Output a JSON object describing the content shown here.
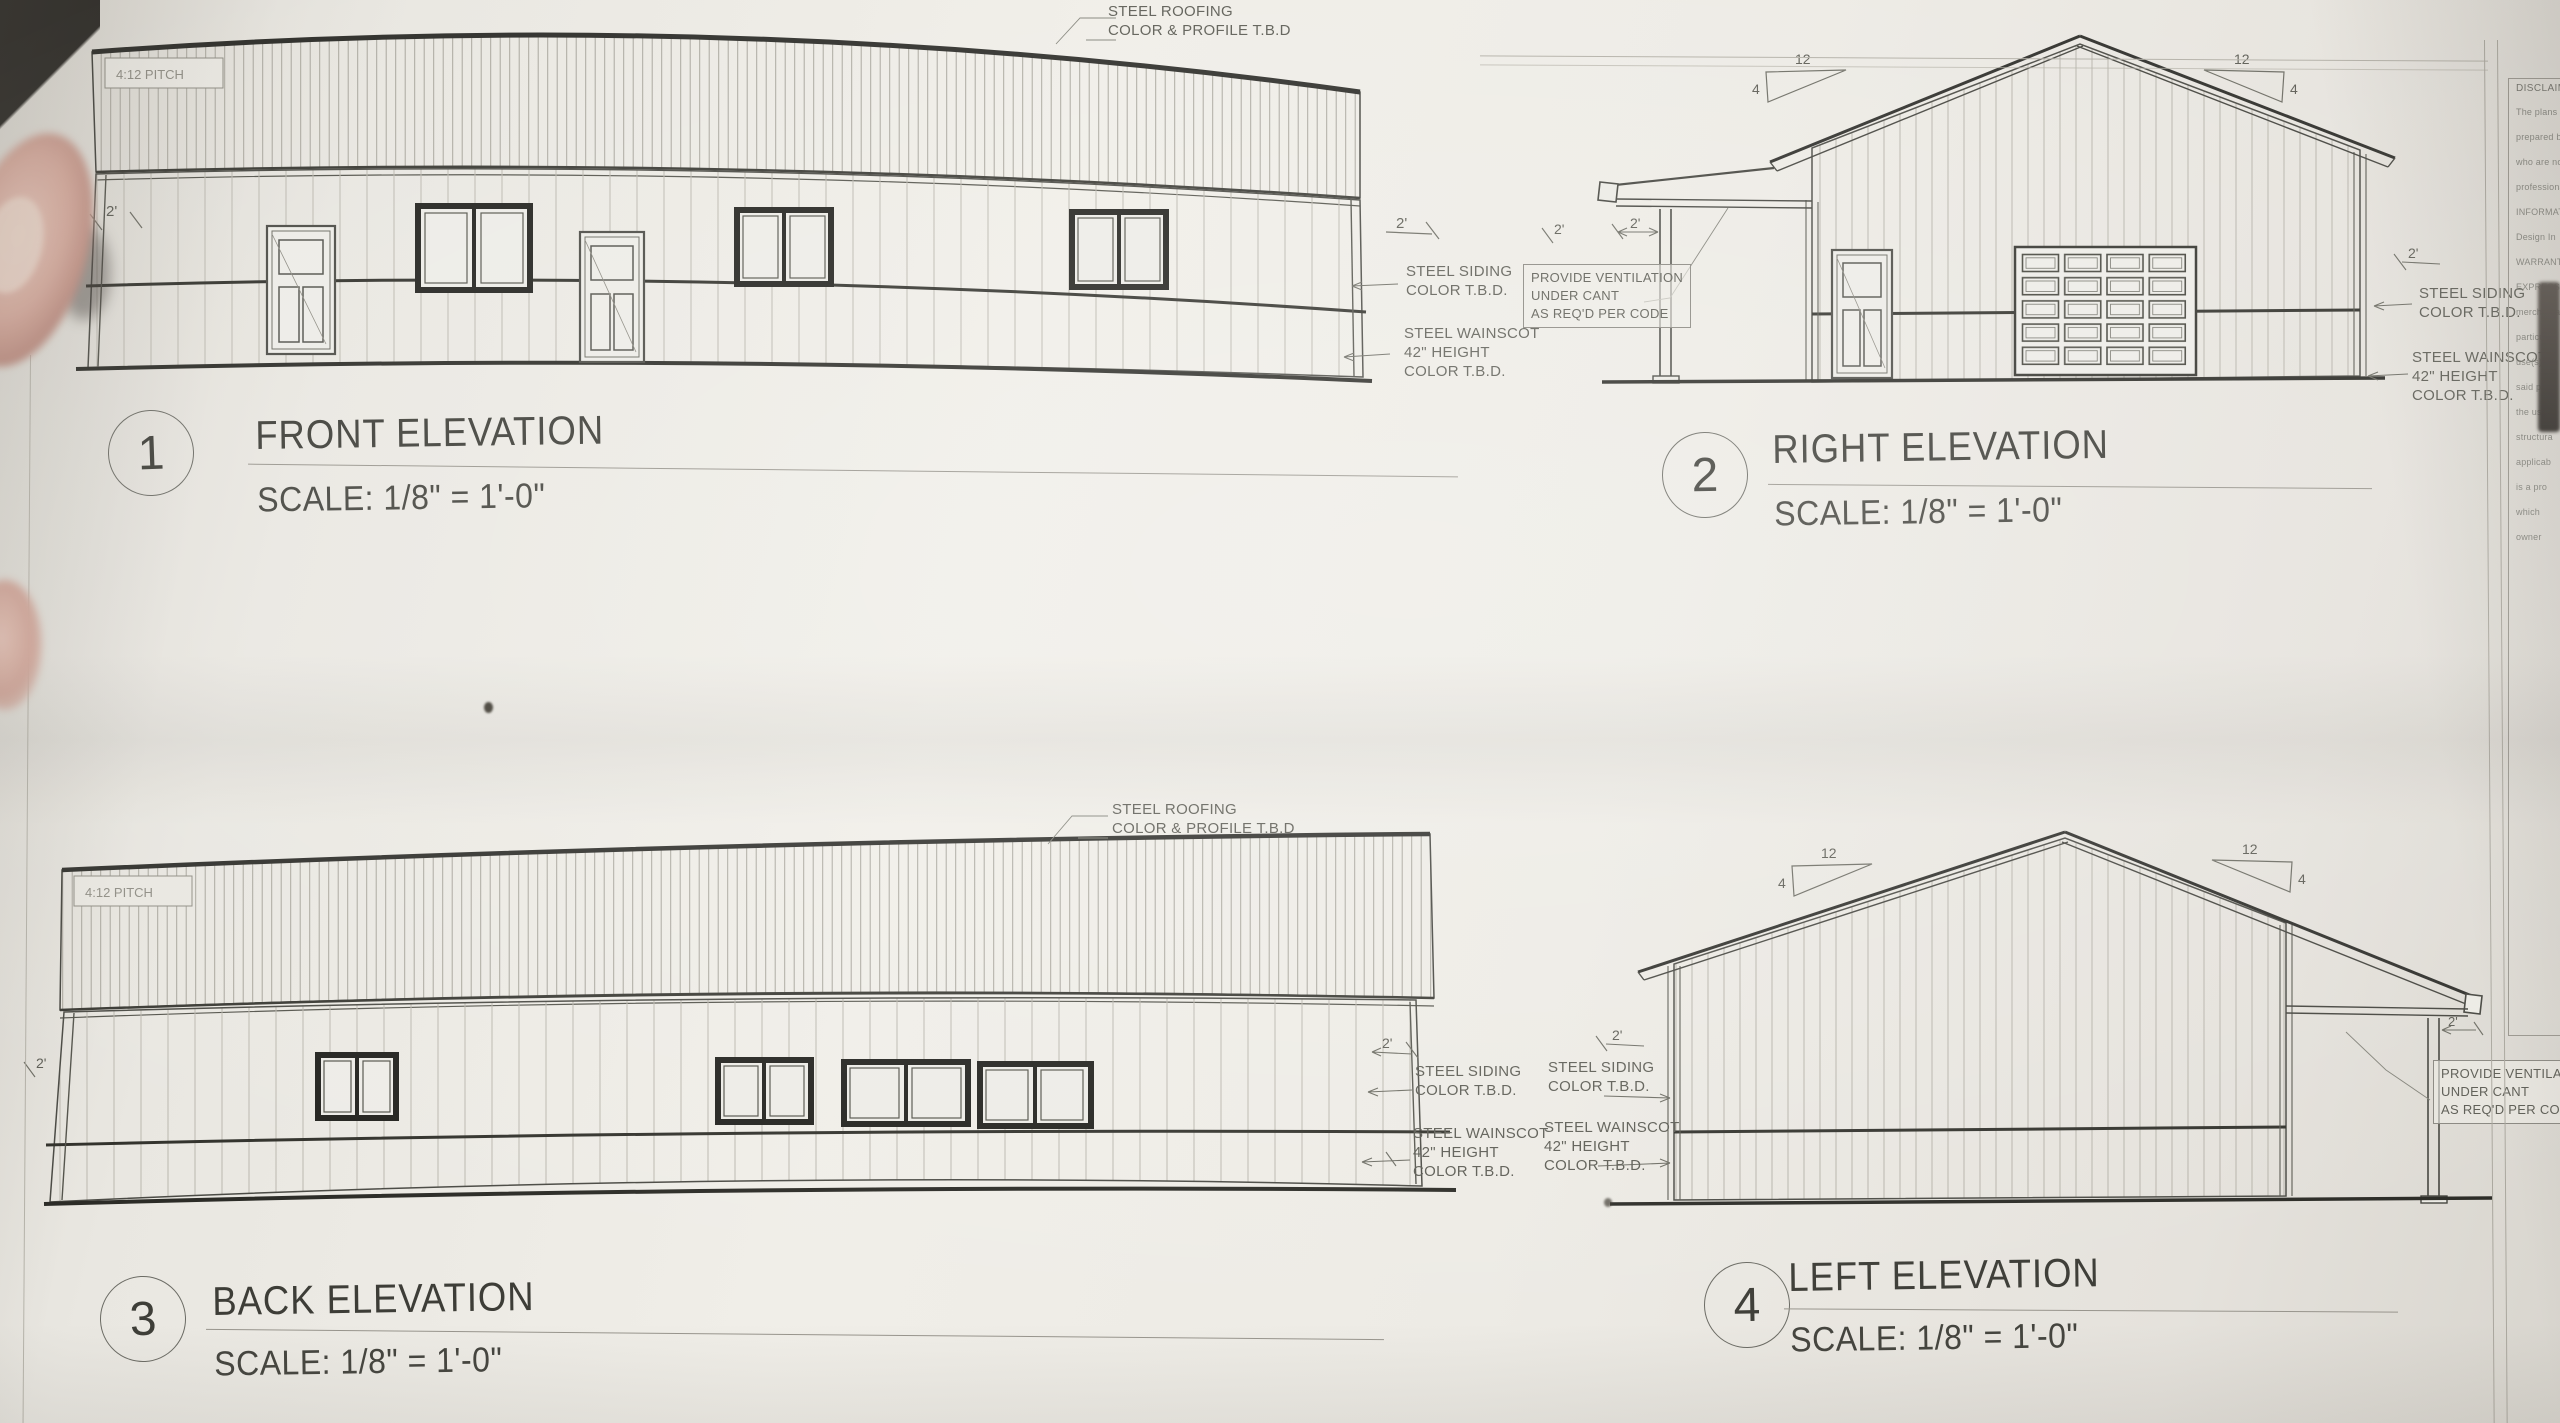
{
  "photo": {
    "paper_color": "#ECEAE4",
    "line_color": "#4B4B45",
    "heavy_line_color": "#26262A"
  },
  "elevations": [
    {
      "num": "1",
      "title": "FRONT ELEVATION",
      "scale": "SCALE: 1/8\" = 1'-0\""
    },
    {
      "num": "2",
      "title": "RIGHT ELEVATION",
      "scale": "SCALE: 1/8\" = 1'-0\""
    },
    {
      "num": "3",
      "title": "BACK ELEVATION",
      "scale": "SCALE: 1/8\" = 1'-0\""
    },
    {
      "num": "4",
      "title": "LEFT ELEVATION",
      "scale": "SCALE: 1/8\" = 1'-0\""
    }
  ],
  "notes": {
    "roofing_1": "STEEL ROOFING",
    "roofing_2": "COLOR & PROFILE T.B.D",
    "siding_1": "STEEL SIDING",
    "siding_2": "COLOR T.B.D.",
    "wainscot_1": "STEEL WAINSCOT",
    "wainscot_2": "42\" HEIGHT",
    "wainscot_3": "COLOR T.B.D.",
    "vent_1": "PROVIDE VENTILATION",
    "vent_2": "UNDER CANT",
    "vent_3": "AS REQ'D PER CODE",
    "pitch_rise": "12",
    "pitch_run": "4",
    "overhang": "2'",
    "pitch_tag": "4:12 PITCH"
  },
  "disclaimer": {
    "title": "DISCLAIMER",
    "lines": [
      "The plans",
      "prepared by",
      "who are not",
      "professional",
      "INFORMATION",
      "Design In",
      "WARRANTIES",
      "EXPRESSED",
      "merchanta",
      "particular",
      "use(s), an",
      "said plan",
      "the user",
      "structura",
      "applicab",
      "is a pro",
      "which",
      "owner"
    ]
  }
}
